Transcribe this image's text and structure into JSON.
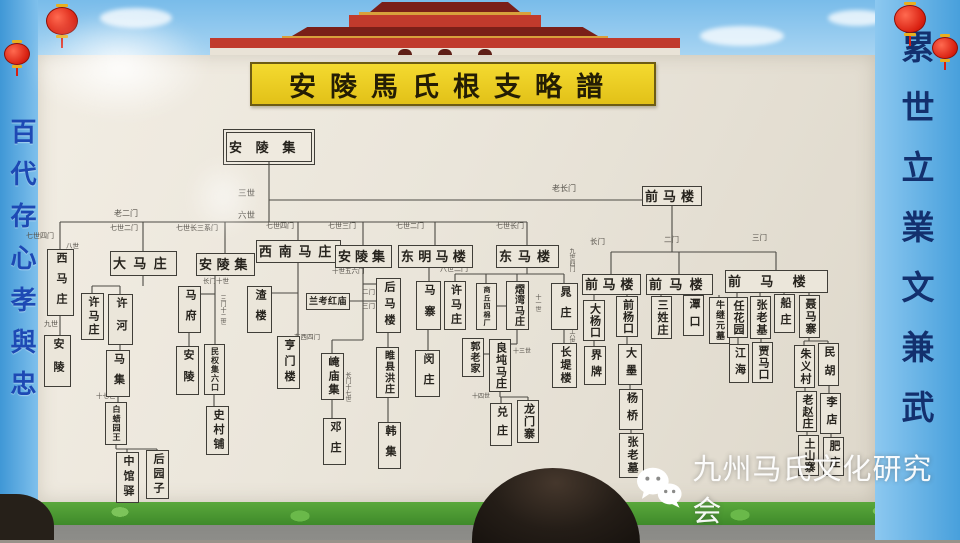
{
  "title": "安陵馬氏根支略譜",
  "banners": {
    "left": "百代存心孝與忠",
    "right": "累世立業文兼武"
  },
  "watermark": {
    "icon": "wechat-icon",
    "text": "九州马氏文化研究会"
  },
  "colors": {
    "title_yellow": "#f0d428",
    "border_blue": "#55aadf",
    "grass_green": "#4f9c34",
    "gate_red": "#c03a2c",
    "lantern_red": "#d81f10",
    "board": "#ebe6da"
  },
  "tree": {
    "nodes": [
      {
        "l": "安陵集",
        "x": 226,
        "y": 132,
        "w": 86,
        "h": 30,
        "v": false,
        "d": true
      },
      {
        "l": "前马楼",
        "x": 642,
        "y": 186,
        "w": 60,
        "h": 20,
        "v": false
      },
      {
        "l": "西马庄",
        "x": 47,
        "y": 249,
        "w": 27,
        "h": 67,
        "v": true
      },
      {
        "l": "大马庄",
        "x": 110,
        "y": 251,
        "w": 67,
        "h": 25,
        "v": false
      },
      {
        "l": "安陵集",
        "x": 196,
        "y": 253,
        "w": 59,
        "h": 23,
        "v": false
      },
      {
        "l": "西南马庄",
        "x": 256,
        "y": 240,
        "w": 85,
        "h": 23,
        "v": false
      },
      {
        "l": "安陵集",
        "x": 335,
        "y": 245,
        "w": 57,
        "h": 23,
        "v": false
      },
      {
        "l": "东明马楼",
        "x": 398,
        "y": 245,
        "w": 75,
        "h": 23,
        "v": false
      },
      {
        "l": "东马楼",
        "x": 496,
        "y": 245,
        "w": 63,
        "h": 23,
        "v": false
      },
      {
        "l": "前马楼",
        "x": 582,
        "y": 274,
        "w": 59,
        "h": 21,
        "v": false
      },
      {
        "l": "前马楼",
        "x": 646,
        "y": 274,
        "w": 67,
        "h": 21,
        "v": false
      },
      {
        "l": "前马楼",
        "x": 725,
        "y": 270,
        "w": 103,
        "h": 23,
        "v": false
      },
      {
        "l": "安陵",
        "x": 44,
        "y": 335,
        "w": 27,
        "h": 52,
        "v": true
      },
      {
        "l": "许马庄",
        "x": 81,
        "y": 293,
        "w": 23,
        "h": 47,
        "v": true
      },
      {
        "l": "许河",
        "x": 108,
        "y": 294,
        "w": 25,
        "h": 51,
        "v": true
      },
      {
        "l": "马集",
        "x": 106,
        "y": 350,
        "w": 24,
        "h": 47,
        "v": true
      },
      {
        "l": "白蜡园王",
        "x": 105,
        "y": 402,
        "w": 22,
        "h": 43,
        "v": true
      },
      {
        "l": "中馆驿",
        "x": 116,
        "y": 452,
        "w": 23,
        "h": 51,
        "v": true
      },
      {
        "l": "后园子",
        "x": 146,
        "y": 450,
        "w": 23,
        "h": 49,
        "v": true
      },
      {
        "l": "马府",
        "x": 178,
        "y": 286,
        "w": 23,
        "h": 47,
        "v": true
      },
      {
        "l": "安陵",
        "x": 176,
        "y": 346,
        "w": 23,
        "h": 49,
        "v": true
      },
      {
        "l": "民权集六口",
        "x": 204,
        "y": 344,
        "w": 21,
        "h": 51,
        "v": true
      },
      {
        "l": "史村铺",
        "x": 206,
        "y": 406,
        "w": 23,
        "h": 49,
        "v": true
      },
      {
        "l": "渣楼",
        "x": 247,
        "y": 286,
        "w": 25,
        "h": 47,
        "v": true
      },
      {
        "l": "亨门楼",
        "x": 277,
        "y": 336,
        "w": 23,
        "h": 53,
        "v": true
      },
      {
        "l": "崦庙集",
        "x": 321,
        "y": 353,
        "w": 23,
        "h": 47,
        "v": true
      },
      {
        "l": "邓庄",
        "x": 323,
        "y": 418,
        "w": 23,
        "h": 47,
        "v": true
      },
      {
        "l": "后马楼",
        "x": 376,
        "y": 278,
        "w": 25,
        "h": 55,
        "v": true
      },
      {
        "l": "兰考红庙",
        "x": 306,
        "y": 293,
        "w": 44,
        "h": 17,
        "v": false
      },
      {
        "l": "睢县洪庄",
        "x": 376,
        "y": 347,
        "w": 23,
        "h": 51,
        "v": true
      },
      {
        "l": "韩集",
        "x": 378,
        "y": 422,
        "w": 23,
        "h": 47,
        "v": true
      },
      {
        "l": "马寨",
        "x": 416,
        "y": 281,
        "w": 25,
        "h": 49,
        "v": true
      },
      {
        "l": "闵庄",
        "x": 415,
        "y": 350,
        "w": 25,
        "h": 47,
        "v": true
      },
      {
        "l": "许马庄",
        "x": 444,
        "y": 281,
        "w": 22,
        "h": 49,
        "v": true
      },
      {
        "l": "商丘四棉厂",
        "x": 476,
        "y": 283,
        "w": 21,
        "h": 47,
        "v": true
      },
      {
        "l": "熠湾马庄",
        "x": 506,
        "y": 281,
        "w": 23,
        "h": 49,
        "v": true
      },
      {
        "l": "晁庄",
        "x": 551,
        "y": 283,
        "w": 27,
        "h": 47,
        "v": true
      },
      {
        "l": "郭老家",
        "x": 462,
        "y": 338,
        "w": 22,
        "h": 39,
        "v": true
      },
      {
        "l": "良坉马庄",
        "x": 489,
        "y": 339,
        "w": 22,
        "h": 53,
        "v": true
      },
      {
        "l": "兑庄",
        "x": 490,
        "y": 403,
        "w": 22,
        "h": 43,
        "v": true
      },
      {
        "l": "龙门寨",
        "x": 517,
        "y": 400,
        "w": 22,
        "h": 43,
        "v": true
      },
      {
        "l": "长堤楼",
        "x": 552,
        "y": 343,
        "w": 25,
        "h": 45,
        "v": true
      },
      {
        "l": "大杨口",
        "x": 583,
        "y": 300,
        "w": 22,
        "h": 41,
        "v": true
      },
      {
        "l": "前杨口",
        "x": 616,
        "y": 296,
        "w": 22,
        "h": 41,
        "v": true
      },
      {
        "l": "界牌",
        "x": 584,
        "y": 346,
        "w": 22,
        "h": 39,
        "v": true
      },
      {
        "l": "大墨",
        "x": 618,
        "y": 344,
        "w": 24,
        "h": 41,
        "v": true
      },
      {
        "l": "杨桥",
        "x": 619,
        "y": 389,
        "w": 24,
        "h": 41,
        "v": true
      },
      {
        "l": "张老墓",
        "x": 619,
        "y": 433,
        "w": 25,
        "h": 45,
        "v": true
      },
      {
        "l": "三姓庄",
        "x": 651,
        "y": 296,
        "w": 21,
        "h": 43,
        "v": true
      },
      {
        "l": "潭口",
        "x": 683,
        "y": 295,
        "w": 21,
        "h": 41,
        "v": true
      },
      {
        "l": "牛继元墓",
        "x": 709,
        "y": 297,
        "w": 21,
        "h": 47,
        "v": true
      },
      {
        "l": "任花园",
        "x": 727,
        "y": 297,
        "w": 21,
        "h": 41,
        "v": true
      },
      {
        "l": "张老基",
        "x": 750,
        "y": 296,
        "w": 21,
        "h": 43,
        "v": true
      },
      {
        "l": "船庄",
        "x": 774,
        "y": 294,
        "w": 21,
        "h": 39,
        "v": true
      },
      {
        "l": "聂马寨",
        "x": 799,
        "y": 295,
        "w": 21,
        "h": 43,
        "v": true
      },
      {
        "l": "江海",
        "x": 729,
        "y": 344,
        "w": 20,
        "h": 39,
        "v": true
      },
      {
        "l": "贾马口",
        "x": 752,
        "y": 342,
        "w": 21,
        "h": 41,
        "v": true
      },
      {
        "l": "朱义村",
        "x": 794,
        "y": 345,
        "w": 21,
        "h": 43,
        "v": true
      },
      {
        "l": "民胡",
        "x": 818,
        "y": 343,
        "w": 21,
        "h": 43,
        "v": true
      },
      {
        "l": "老赵庄",
        "x": 796,
        "y": 391,
        "w": 21,
        "h": 41,
        "v": true
      },
      {
        "l": "李店",
        "x": 820,
        "y": 393,
        "w": 21,
        "h": 41,
        "v": true
      },
      {
        "l": "土山寨",
        "x": 798,
        "y": 435,
        "w": 21,
        "h": 41,
        "v": true
      },
      {
        "l": "肥庄",
        "x": 823,
        "y": 437,
        "w": 21,
        "h": 39,
        "v": true
      }
    ],
    "labels": [
      {
        "t": "三世",
        "x": 238,
        "y": 189,
        "s": 8.5
      },
      {
        "t": "六世",
        "x": 238,
        "y": 211,
        "s": 8.5
      },
      {
        "t": "老长门",
        "x": 552,
        "y": 185,
        "s": 8
      },
      {
        "t": "老二门",
        "x": 114,
        "y": 210,
        "s": 8
      },
      {
        "t": "七世四门",
        "x": 26,
        "y": 233,
        "s": 7
      },
      {
        "t": "七世二门",
        "x": 110,
        "y": 225,
        "s": 7
      },
      {
        "t": "七世长三系门",
        "x": 176,
        "y": 225,
        "s": 7
      },
      {
        "t": "七世四门",
        "x": 266,
        "y": 223,
        "s": 7
      },
      {
        "t": "七世三门",
        "x": 328,
        "y": 223,
        "s": 7
      },
      {
        "t": "七世二门",
        "x": 396,
        "y": 223,
        "s": 7
      },
      {
        "t": "七世长门",
        "x": 496,
        "y": 223,
        "s": 7
      },
      {
        "t": "长门",
        "x": 590,
        "y": 238,
        "s": 7.5
      },
      {
        "t": "二门",
        "x": 664,
        "y": 236,
        "s": 7.5
      },
      {
        "t": "三门",
        "x": 752,
        "y": 234,
        "s": 7.5
      },
      {
        "t": "八世",
        "x": 66,
        "y": 244,
        "s": 6.5
      },
      {
        "t": "九世",
        "x": 44,
        "y": 321,
        "s": 7
      },
      {
        "t": "长门十世",
        "x": 203,
        "y": 279,
        "s": 6.5
      },
      {
        "t": "三门十二世",
        "x": 219,
        "y": 295,
        "s": 6,
        "v": true
      },
      {
        "t": "十七世",
        "x": 96,
        "y": 394,
        "s": 6.5
      },
      {
        "t": "十世五六门",
        "x": 332,
        "y": 269,
        "s": 6.5
      },
      {
        "t": "二门",
        "x": 362,
        "y": 290,
        "s": 6.5
      },
      {
        "t": "三门",
        "x": 362,
        "y": 304,
        "s": 6.5
      },
      {
        "t": "东西四门",
        "x": 294,
        "y": 335,
        "s": 6.5
      },
      {
        "t": "长门十七世",
        "x": 344,
        "y": 372,
        "s": 6,
        "v": true
      },
      {
        "t": "八世二门",
        "x": 440,
        "y": 266,
        "s": 7
      },
      {
        "t": "九世四门",
        "x": 568,
        "y": 248,
        "s": 6,
        "v": true
      },
      {
        "t": "十一世",
        "x": 534,
        "y": 294,
        "s": 6,
        "v": true
      },
      {
        "t": "十六世",
        "x": 568,
        "y": 326,
        "s": 6,
        "v": true
      },
      {
        "t": "十三世",
        "x": 513,
        "y": 349,
        "s": 6
      },
      {
        "t": "十四世",
        "x": 472,
        "y": 394,
        "s": 6
      }
    ],
    "edges": [
      [
        269,
        162,
        269,
        222
      ],
      [
        269,
        200,
        642,
        200
      ],
      [
        60,
        222,
        527,
        222
      ],
      [
        60,
        222,
        60,
        249
      ],
      [
        143,
        222,
        143,
        251
      ],
      [
        225,
        222,
        225,
        253
      ],
      [
        298,
        222,
        298,
        240
      ],
      [
        363,
        222,
        363,
        245
      ],
      [
        435,
        222,
        435,
        245
      ],
      [
        527,
        222,
        527,
        245
      ],
      [
        672,
        206,
        672,
        252
      ],
      [
        611,
        252,
        776,
        252
      ],
      [
        611,
        252,
        611,
        274
      ],
      [
        679,
        252,
        679,
        274
      ],
      [
        776,
        252,
        776,
        270
      ],
      [
        594,
        295,
        594,
        300
      ],
      [
        627,
        295,
        627,
        296
      ],
      [
        594,
        341,
        594,
        346
      ],
      [
        627,
        337,
        627,
        344
      ],
      [
        630,
        385,
        630,
        389
      ],
      [
        631,
        430,
        631,
        433
      ],
      [
        661,
        295,
        661,
        296
      ],
      [
        693,
        295,
        693,
        295
      ],
      [
        719,
        295,
        719,
        297
      ],
      [
        737,
        293,
        737,
        297
      ],
      [
        760,
        293,
        760,
        296
      ],
      [
        784,
        293,
        784,
        295
      ],
      [
        809,
        293,
        809,
        295
      ],
      [
        738,
        338,
        738,
        344
      ],
      [
        761,
        339,
        761,
        342
      ],
      [
        809,
        338,
        809,
        341
      ],
      [
        804,
        341,
        828,
        341
      ],
      [
        804,
        341,
        804,
        345
      ],
      [
        828,
        341,
        828,
        343
      ],
      [
        805,
        388,
        805,
        391
      ],
      [
        807,
        432,
        807,
        435
      ],
      [
        829,
        386,
        829,
        393
      ],
      [
        831,
        434,
        831,
        437
      ],
      [
        60,
        316,
        60,
        335
      ],
      [
        143,
        276,
        143,
        286
      ],
      [
        92,
        286,
        120,
        286
      ],
      [
        92,
        286,
        92,
        293
      ],
      [
        120,
        286,
        120,
        294
      ],
      [
        120,
        345,
        120,
        350
      ],
      [
        118,
        397,
        118,
        402
      ],
      [
        116,
        445,
        116,
        449
      ],
      [
        116,
        449,
        157,
        449
      ],
      [
        127,
        449,
        127,
        452
      ],
      [
        157,
        449,
        157,
        450
      ],
      [
        215,
        276,
        215,
        344
      ],
      [
        201,
        294,
        215,
        294
      ],
      [
        189,
        333,
        189,
        346
      ],
      [
        214,
        395,
        214,
        406
      ],
      [
        298,
        263,
        298,
        336
      ],
      [
        272,
        293,
        298,
        293
      ],
      [
        363,
        268,
        363,
        340
      ],
      [
        363,
        284,
        376,
        284
      ],
      [
        350,
        301,
        376,
        301
      ],
      [
        388,
        333,
        388,
        347
      ],
      [
        388,
        398,
        388,
        422
      ],
      [
        332,
        340,
        363,
        340
      ],
      [
        332,
        340,
        332,
        353
      ],
      [
        332,
        400,
        332,
        418
      ],
      [
        429,
        268,
        429,
        281
      ],
      [
        428,
        330,
        428,
        350
      ],
      [
        527,
        268,
        527,
        274
      ],
      [
        455,
        274,
        564,
        274
      ],
      [
        455,
        274,
        455,
        281
      ],
      [
        486,
        274,
        486,
        283
      ],
      [
        517,
        274,
        517,
        281
      ],
      [
        564,
        274,
        564,
        283
      ],
      [
        497,
        306,
        506,
        306
      ],
      [
        517,
        330,
        517,
        344
      ],
      [
        511,
        344,
        517,
        344
      ],
      [
        484,
        354,
        489,
        354
      ],
      [
        500,
        392,
        500,
        397
      ],
      [
        500,
        397,
        528,
        397
      ],
      [
        501,
        397,
        501,
        403
      ],
      [
        528,
        397,
        528,
        400
      ],
      [
        564,
        330,
        564,
        343
      ]
    ]
  }
}
